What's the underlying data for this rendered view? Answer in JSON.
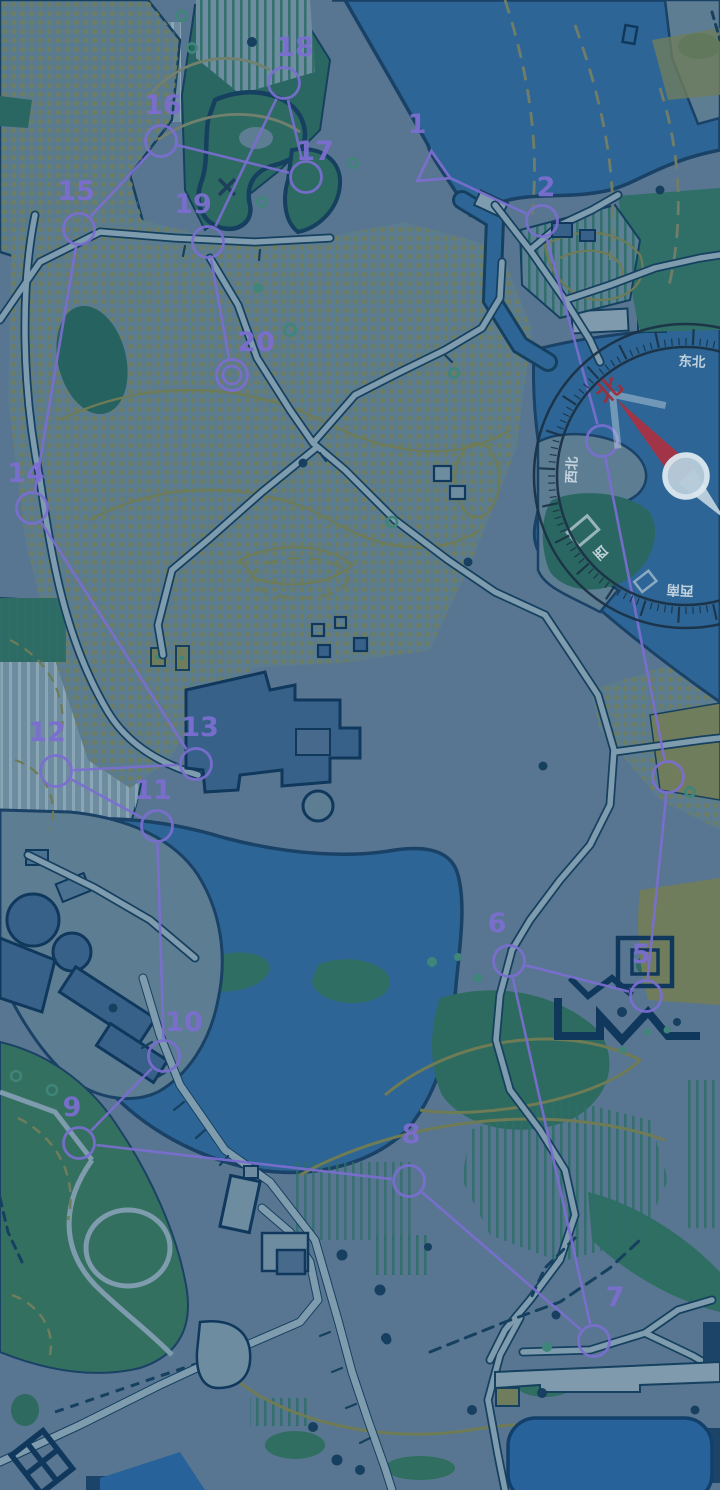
{
  "screen": {
    "width": 720,
    "height": 1490,
    "kind": "orienteering-game-map"
  },
  "palette": {
    "ground": "#587691",
    "ground_light": "#6d8ca0",
    "path_fill": "#7f9cae",
    "water": "#2d6696",
    "water_dark": "#27639a",
    "outline_navy": "#16405f",
    "veg_dark": "#2b6762",
    "veg_mid": "#3a7468",
    "khaki": "#6f7d5c",
    "dots_olive": "#6e7e60",
    "stripe_green": "#2e6e6a",
    "stripe_light": "#8fa9b8",
    "contour": "#6e7b55",
    "contour_gray": "#707d68",
    "building": "#38618a",
    "building_pale": "#7e9aac",
    "course_purple": "#7b6ed0"
  },
  "course": {
    "color": "#7b6ed0",
    "points": [
      {
        "n": "1",
        "kind": "start",
        "x": 433,
        "y": 170,
        "lx": 417,
        "ly": 133,
        "label_visible": true
      },
      {
        "n": "2",
        "kind": "control",
        "x": 542,
        "y": 221,
        "lx": 546,
        "ly": 196,
        "label_visible": true
      },
      {
        "n": "3",
        "kind": "control",
        "x": 602,
        "y": 441,
        "lx": 0,
        "ly": 0,
        "label_visible": false
      },
      {
        "n": "4",
        "kind": "control",
        "x": 668,
        "y": 777,
        "lx": 0,
        "ly": 0,
        "label_visible": false
      },
      {
        "n": "5",
        "kind": "control",
        "x": 646,
        "y": 996,
        "lx": 641,
        "ly": 963,
        "label_visible": true
      },
      {
        "n": "6",
        "kind": "control",
        "x": 509,
        "y": 961,
        "lx": 497,
        "ly": 932,
        "label_visible": true
      },
      {
        "n": "7",
        "kind": "control",
        "x": 594,
        "y": 1341,
        "lx": 615,
        "ly": 1306,
        "label_visible": true
      },
      {
        "n": "8",
        "kind": "control",
        "x": 409,
        "y": 1181,
        "lx": 411,
        "ly": 1143,
        "label_visible": true
      },
      {
        "n": "9",
        "kind": "control",
        "x": 79,
        "y": 1143,
        "lx": 72,
        "ly": 1116,
        "label_visible": true
      },
      {
        "n": "10",
        "kind": "control",
        "x": 164,
        "y": 1056,
        "lx": 184,
        "ly": 1031,
        "label_visible": true
      },
      {
        "n": "11",
        "kind": "control",
        "x": 157,
        "y": 826,
        "lx": 153,
        "ly": 799,
        "label_visible": true
      },
      {
        "n": "12",
        "kind": "control",
        "x": 56,
        "y": 771,
        "lx": 47,
        "ly": 741,
        "label_visible": true
      },
      {
        "n": "13",
        "kind": "control",
        "x": 196,
        "y": 764,
        "lx": 200,
        "ly": 736,
        "label_visible": true
      },
      {
        "n": "14",
        "kind": "control",
        "x": 32,
        "y": 508,
        "lx": 26,
        "ly": 482,
        "label_visible": true
      },
      {
        "n": "15",
        "kind": "control",
        "x": 79,
        "y": 229,
        "lx": 76,
        "ly": 200,
        "label_visible": true
      },
      {
        "n": "16",
        "kind": "control",
        "x": 161,
        "y": 141,
        "lx": 163,
        "ly": 114,
        "label_visible": true
      },
      {
        "n": "17",
        "kind": "control",
        "x": 306,
        "y": 177,
        "lx": 315,
        "ly": 160,
        "label_visible": true
      },
      {
        "n": "18",
        "kind": "control",
        "x": 284,
        "y": 83,
        "lx": 295,
        "ly": 56,
        "label_visible": true
      },
      {
        "n": "19",
        "kind": "control",
        "x": 208,
        "y": 242,
        "lx": 193,
        "ly": 213,
        "label_visible": true
      },
      {
        "n": "20",
        "kind": "finish",
        "x": 232,
        "y": 375,
        "lx": 256,
        "ly": 351,
        "label_visible": true
      }
    ]
  },
  "compass": {
    "center_x": 686,
    "center_y": 476,
    "rotation_deg": -42,
    "ring_color": "#1b3246",
    "outer_r": 152,
    "inner_r": 129,
    "labels": [
      {
        "text": "北",
        "angle": 0,
        "color": "#9d2f3c",
        "size": 25
      },
      {
        "text": "东北",
        "angle": 45,
        "color": "#c9d7e0",
        "size": 13.5
      },
      {
        "text": "西北",
        "angle": -45,
        "color": "#c9d7e0",
        "size": 13.5
      },
      {
        "text": "西",
        "angle": -90,
        "color": "#c9d7e0",
        "size": 13.5
      },
      {
        "text": "西南",
        "angle": -135,
        "color": "#c9d7e0",
        "size": 13.5
      }
    ],
    "needle": {
      "red": "#a83342",
      "pale": "#c5d7e1",
      "hub_fill": "#b6cddb",
      "hub_ring": "#dce9f0"
    }
  }
}
